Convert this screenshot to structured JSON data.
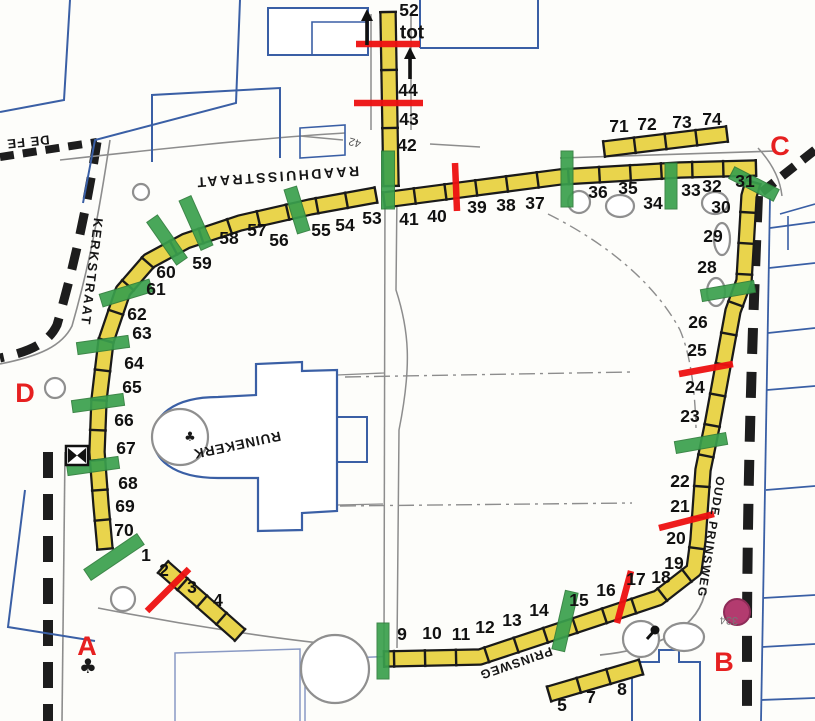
{
  "colors": {
    "stall_fill": "#e9d44c",
    "stall_border": "#1a1a1a",
    "green": "#3aa04d",
    "green_edge": "#2e7d3b",
    "red": "#ee1111",
    "letter_red": "#e62020",
    "blue": "#3a5fa5",
    "grayblue": "#8a9ac4",
    "gray": "#8d8d8d",
    "road_black": "#1d1d1d",
    "purple": "#b33b6f",
    "purple_edge": "#8e2c58",
    "label_black": "#111111"
  },
  "street_labels": [
    {
      "text": "RAADHUISSTRAAT",
      "x": 277,
      "y": 177,
      "rotate": 176,
      "size": 14,
      "spacing": 2.5
    },
    {
      "text": "KERKSTRAAT",
      "x": 92,
      "y": 272,
      "rotate": 97,
      "size": 13,
      "spacing": 2
    },
    {
      "text": "OUDE PRINSWEG",
      "x": 711,
      "y": 537,
      "rotate": 99,
      "size": 12,
      "spacing": 1.5
    },
    {
      "text": "PRINSWEG",
      "x": 516,
      "y": 663,
      "rotate": 161,
      "size": 12.5,
      "spacing": 1
    },
    {
      "text": "RUINEKERK",
      "x": 237,
      "y": 445,
      "rotate": 168,
      "size": 13.5,
      "spacing": 1
    },
    {
      "text": "DE FE",
      "x": 28,
      "y": 142,
      "rotate": 174,
      "size": 13,
      "spacing": 1
    }
  ],
  "misc_labels": [
    {
      "text": "tot",
      "x": 412,
      "y": 33,
      "size": 19,
      "color": "#111111",
      "rotate": 0,
      "bold": true
    },
    {
      "text": "42",
      "x": 355,
      "y": 142,
      "size": 11,
      "color": "#555555",
      "rotate": 195,
      "bold": false
    },
    {
      "text": "334",
      "x": 729,
      "y": 620,
      "size": 11,
      "color": "#777777",
      "rotate": 182,
      "bold": false
    }
  ],
  "stall_numbers": [
    [
      "52",
      409,
      10
    ],
    [
      "44",
      408,
      90
    ],
    [
      "43",
      409,
      119
    ],
    [
      "42",
      407,
      145
    ],
    [
      "41",
      409,
      219
    ],
    [
      "40",
      437,
      216
    ],
    [
      "39",
      477,
      207
    ],
    [
      "38",
      506,
      205
    ],
    [
      "37",
      535,
      203
    ],
    [
      "36",
      598,
      192
    ],
    [
      "35",
      628,
      188
    ],
    [
      "34",
      653,
      203
    ],
    [
      "33",
      691,
      190
    ],
    [
      "32",
      712,
      186
    ],
    [
      "31",
      745,
      181
    ],
    [
      "71",
      619,
      126
    ],
    [
      "72",
      647,
      124
    ],
    [
      "73",
      682,
      122
    ],
    [
      "74",
      712,
      119
    ],
    [
      "30",
      721,
      207
    ],
    [
      "29",
      713,
      236
    ],
    [
      "28",
      707,
      267
    ],
    [
      "26",
      698,
      322
    ],
    [
      "25",
      697,
      350
    ],
    [
      "24",
      695,
      387
    ],
    [
      "23",
      690,
      416
    ],
    [
      "22",
      680,
      481
    ],
    [
      "21",
      680,
      506
    ],
    [
      "20",
      676,
      538
    ],
    [
      "19",
      674,
      563
    ],
    [
      "18",
      661,
      577
    ],
    [
      "17",
      636,
      579
    ],
    [
      "16",
      606,
      590
    ],
    [
      "15",
      579,
      600
    ],
    [
      "14",
      539,
      610
    ],
    [
      "13",
      512,
      620
    ],
    [
      "12",
      485,
      627
    ],
    [
      "11",
      461,
      634
    ],
    [
      "10",
      432,
      633
    ],
    [
      "9",
      402,
      634
    ],
    [
      "8",
      622,
      689
    ],
    [
      "7",
      591,
      697
    ],
    [
      "5",
      562,
      705
    ],
    [
      "53",
      372,
      218
    ],
    [
      "54",
      345,
      225
    ],
    [
      "55",
      321,
      230
    ],
    [
      "56",
      279,
      240
    ],
    [
      "57",
      257,
      230
    ],
    [
      "58",
      229,
      238
    ],
    [
      "59",
      202,
      263
    ],
    [
      "60",
      166,
      272
    ],
    [
      "61",
      156,
      289
    ],
    [
      "62",
      137,
      314
    ],
    [
      "63",
      142,
      333
    ],
    [
      "64",
      134,
      363
    ],
    [
      "65",
      132,
      387
    ],
    [
      "66",
      124,
      420
    ],
    [
      "67",
      126,
      448
    ],
    [
      "68",
      128,
      483
    ],
    [
      "69",
      125,
      506
    ],
    [
      "70",
      124,
      530
    ],
    [
      "1",
      146,
      555
    ],
    [
      "2",
      164,
      570
    ],
    [
      "3",
      192,
      587
    ],
    [
      "4",
      218,
      600
    ]
  ],
  "entrance_letters": [
    {
      "t": "A",
      "x": 87,
      "y": 646
    },
    {
      "t": "B",
      "x": 724,
      "y": 662
    },
    {
      "t": "C",
      "x": 780,
      "y": 146
    },
    {
      "t": "D",
      "x": 25,
      "y": 393
    }
  ],
  "strips": [
    {
      "name": "strip-north-vertical",
      "width": 13,
      "seg": 58,
      "points": [
        [
          388,
          12
        ],
        [
          391,
          186
        ]
      ]
    },
    {
      "name": "strip-north-row",
      "width": 13,
      "seg": 31,
      "points": [
        [
          384,
          200
        ],
        [
          460,
          190
        ],
        [
          560,
          177
        ],
        [
          680,
          170
        ],
        [
          756,
          168
        ]
      ]
    },
    {
      "name": "strip-71-74",
      "width": 13,
      "seg": 31,
      "points": [
        [
          604,
          149
        ],
        [
          727,
          134
        ]
      ]
    },
    {
      "name": "strip-east-south",
      "width": 13,
      "seg": 31,
      "points": [
        [
          753,
          182
        ],
        [
          749,
          196
        ],
        [
          744,
          281
        ],
        [
          733,
          311
        ],
        [
          712,
          426
        ],
        [
          703,
          470
        ],
        [
          698,
          540
        ],
        [
          694,
          570
        ],
        [
          658,
          598
        ],
        [
          480,
          657
        ],
        [
          384,
          659
        ]
      ]
    },
    {
      "name": "strip-west",
      "width": 13,
      "seg": 30,
      "points": [
        [
          376,
          195
        ],
        [
          310,
          207
        ],
        [
          240,
          223
        ],
        [
          186,
          241
        ],
        [
          149,
          261
        ],
        [
          123,
          291
        ],
        [
          106,
          341
        ],
        [
          99,
          400
        ],
        [
          97,
          452
        ],
        [
          101,
          505
        ],
        [
          105,
          549
        ]
      ]
    },
    {
      "name": "strip-sw-diagonal",
      "width": 13,
      "seg": 26,
      "points": [
        [
          163,
          567
        ],
        [
          240,
          635
        ]
      ]
    },
    {
      "name": "strip-south-row",
      "width": 13,
      "seg": 31,
      "points": [
        [
          549,
          694
        ],
        [
          641,
          667
        ]
      ]
    }
  ],
  "green_bars": [
    [
      388,
      180,
      58,
      13,
      90
    ],
    [
      567,
      179,
      56,
      12,
      90
    ],
    [
      671,
      186,
      46,
      12,
      90
    ],
    [
      754,
      184,
      50,
      13,
      27
    ],
    [
      728,
      291,
      54,
      12,
      -10
    ],
    [
      701,
      443,
      52,
      12,
      -10
    ],
    [
      565,
      621,
      60,
      13,
      103
    ],
    [
      383,
      651,
      56,
      12,
      90
    ],
    [
      114,
      557,
      64,
      13,
      -34
    ],
    [
      196,
      223,
      54,
      13,
      66
    ],
    [
      167,
      240,
      52,
      13,
      55
    ],
    [
      126,
      293,
      52,
      13,
      -17
    ],
    [
      103,
      345,
      52,
      12,
      -8
    ],
    [
      98,
      403,
      52,
      12,
      -8
    ],
    [
      93,
      466,
      52,
      12,
      -8
    ],
    [
      297,
      210,
      46,
      13,
      73
    ]
  ],
  "red_lines": [
    [
      356,
      44,
      420,
      44
    ],
    [
      354,
      103,
      423,
      103
    ],
    [
      455,
      163,
      457,
      211
    ],
    [
      679,
      374,
      733,
      364
    ],
    [
      659,
      528,
      714,
      514
    ],
    [
      617,
      623,
      631,
      571
    ],
    [
      147,
      611,
      189,
      569
    ]
  ],
  "arrows": [
    [
      367,
      45,
      10
    ],
    [
      410,
      79,
      48
    ]
  ],
  "symbols": {
    "purple_circle": {
      "cx": 737,
      "cy": 612,
      "r": 13
    },
    "crossing_box": {
      "x": 66,
      "y": 446,
      "w": 22,
      "h": 19
    },
    "monument": {
      "cx": 655,
      "cy": 630,
      "x2": 647,
      "y2": 639
    },
    "tree_glyphs": [
      {
        "x": 88,
        "y": 673,
        "size": 20
      },
      {
        "x": 190,
        "y": 441,
        "size": 13
      }
    ]
  },
  "decor": {
    "trees": [
      [
        141,
        192,
        8,
        8
      ],
      [
        55,
        388,
        10,
        10
      ],
      [
        180,
        437,
        28,
        28
      ],
      [
        123,
        599,
        12,
        12
      ],
      [
        335,
        669,
        34,
        34
      ],
      [
        641,
        639,
        18,
        18
      ],
      [
        684,
        637,
        20,
        14
      ],
      [
        579,
        202,
        11,
        11
      ],
      [
        620,
        206,
        14,
        11
      ],
      [
        715,
        203,
        13,
        11
      ],
      [
        722,
        239,
        8,
        16
      ],
      [
        716,
        292,
        9,
        14
      ]
    ],
    "paths": [
      {
        "d": "M 0,157 L 97,142",
        "s": "road",
        "w": 8,
        "dash": "14 9"
      },
      {
        "d": "M 97,142 C 85,220 70,280 57,325 C 48,344 28,352 0,358",
        "s": "road",
        "w": 9,
        "dash": "22 14"
      },
      {
        "d": "M 48,452 L 48,721",
        "s": "road",
        "w": 10,
        "dash": "26 16"
      },
      {
        "d": "M 758,196 C 752,340 748,470 747,620 L 747,721",
        "s": "road",
        "w": 10,
        "dash": "26 18"
      },
      {
        "d": "M 815,150 L 762,192",
        "s": "road",
        "w": 9,
        "dash": "16 10"
      },
      {
        "d": "M 60,160 C 150,150 260,138 345,133",
        "s": "gray",
        "w": 1.6
      },
      {
        "d": "M 560,158 L 775,151",
        "s": "gray",
        "w": 1.6
      },
      {
        "d": "M 110,140 C 98,220 88,270 72,326 C 62,346 40,356 0,364",
        "s": "gray",
        "w": 1.6
      },
      {
        "d": "M 65,452 L 62,721",
        "s": "gray",
        "w": 1.6
      },
      {
        "d": "M 98,608 C 180,624 280,640 350,646",
        "s": "gray",
        "w": 1.6
      },
      {
        "d": "M 600,655 C 660,649 700,627 706,588",
        "s": "gray",
        "w": 1.8
      },
      {
        "d": "M 758,148 C 771,162 780,178 782,196",
        "s": "gray",
        "w": 1.5
      },
      {
        "d": "M 371,130 L 371,14",
        "s": "gray",
        "w": 1.5
      },
      {
        "d": "M 411,130 L 411,14",
        "s": "gray",
        "w": 1.5
      },
      {
        "d": "M 300,136 L 343,140",
        "s": "gray",
        "w": 1.4
      },
      {
        "d": "M 430,144 L 480,147",
        "s": "gray",
        "w": 1.4
      },
      {
        "d": "M 385,192 L 384,650",
        "s": "gray",
        "w": 1.5
      },
      {
        "d": "M 397,192 L 396,290 C 409,330 412,365 399,430 L 397,648",
        "s": "gray",
        "w": 1.5
      },
      {
        "d": "M 337,375 L 384,373",
        "s": "gray",
        "w": 1.3
      },
      {
        "d": "M 337,505 L 383,504",
        "s": "gray",
        "w": 1.3
      },
      {
        "d": "M 345,377 L 630,372",
        "s": "gray",
        "w": 1.4,
        "dash": "16 5 3 5"
      },
      {
        "d": "M 340,506 L 632,503",
        "s": "gray",
        "w": 1.4,
        "dash": "16 5 3 5"
      },
      {
        "d": "M 548,214 C 612,246 657,287 680,330 C 691,356 695,392 696,428",
        "s": "gray",
        "w": 1.4,
        "dash": "12 5 3 5"
      },
      {
        "d": "M 70,0 L 64,100 L 0,112",
        "s": "blue",
        "w": 2
      },
      {
        "d": "M 240,0 L 236,103 L 95,140 L 83,203",
        "s": "blue",
        "w": 2
      },
      {
        "d": "M 152,162 L 152,95 L 280,88 L 280,158",
        "s": "blue",
        "w": 2
      },
      {
        "d": "M 268,55 L 268,8 L 368,8 L 368,55 Z",
        "s": "blue",
        "w": 2,
        "f": "#ffffff"
      },
      {
        "d": "M 312,55 L 312,22 L 368,22",
        "s": "blue",
        "w": 1.6
      },
      {
        "d": "M 420,48 L 420,0 M 420,48 L 538,48 L 538,0",
        "s": "blue",
        "w": 2
      },
      {
        "d": "M 300,128 L 345,125 L 345,155 L 300,158 Z",
        "s": "blue",
        "w": 1.6
      },
      {
        "d": "M 256,393 L 256,364 L 302,362 L 302,371 L 337,370 L 337,511 L 302,513 L 302,530 L 258,531 L 258,478 L 218,478 C 172,478 153,458 153,438 C 153,417 172,397 218,397 L 256,395 Z",
        "s": "blue",
        "w": 2.2,
        "f": "#ffffff"
      },
      {
        "d": "M 337,417 L 367,417 L 367,462 L 337,462",
        "s": "blue",
        "w": 2
      },
      {
        "d": "M 770,198 L 761,721",
        "s": "blue",
        "w": 1.8
      },
      {
        "d": "M 770,228 L 815,222 M 769,268 L 815,263 M 768,333 L 815,328 M 767,390 L 815,386 M 766,490 L 815,486 M 763,598 L 815,595 M 762,647 L 815,644 M 761,700 L 815,698",
        "s": "blue",
        "w": 1.8
      },
      {
        "d": "M 780,214 L 815,204 M 788,216 L 788,250",
        "s": "blue",
        "w": 1.6
      },
      {
        "d": "M 632,721 L 632,662 L 659,662 L 659,650 L 679,650 L 679,662 L 700,662 L 700,721",
        "s": "blue",
        "w": 2
      },
      {
        "d": "M 25,490 L 8,627 L 95,641",
        "s": "blue",
        "w": 2
      },
      {
        "d": "M 175,721 L 175,653 L 300,649 L 300,721",
        "s": "grayblue",
        "w": 1.5
      },
      {
        "d": "M 305,721 L 305,660 L 395,656",
        "s": "grayblue",
        "w": 1.5
      }
    ]
  }
}
